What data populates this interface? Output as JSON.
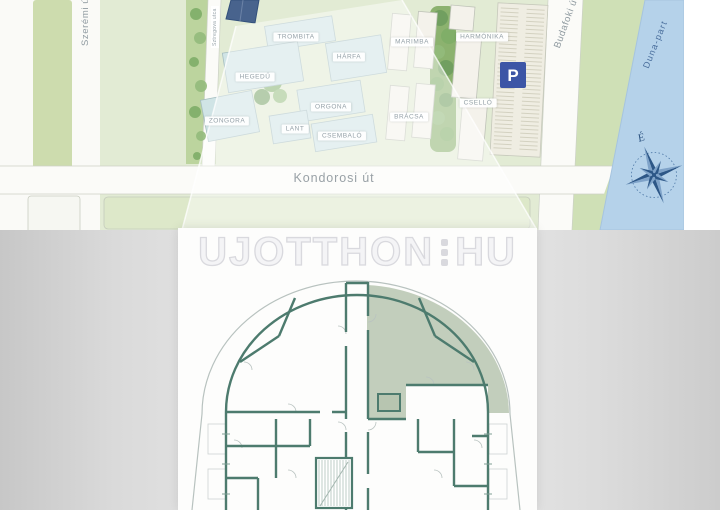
{
  "site_plan": {
    "streets": {
      "szeremi": "Szerémi út",
      "sztregova": "Sztregova utca",
      "kondorosi": "Kondorosi út",
      "budafoki": "Budafoki út",
      "duna_part": "Duna-part"
    },
    "compass_north": "É",
    "parking": "P",
    "buildings": [
      "ZONGORA",
      "HEGEDŰ",
      "TROMBITA",
      "HÁRFA",
      "ORGONA",
      "LANT",
      "CSEMBALÓ",
      "MARIMBA",
      "BRÁCSA",
      "HARMÓNIKA",
      "CSELLÓ"
    ],
    "colors": {
      "grass": "#e2ebd4",
      "median_green": "#cddcae",
      "tree_green": "#7fae68",
      "water_blue": "#b5d2ea",
      "compass_blue": "#2d5787",
      "teal_roof": "#d0e4e6",
      "selected_building_blue": "#48638d",
      "parking_blue": "#3c55a6",
      "label_gray": "#95a1a8"
    }
  },
  "watermark": {
    "name": "UJOTTHON",
    "tld": "HU"
  },
  "floor_plan": {
    "highlighted_unit": "top-right wing",
    "colors": {
      "wall_teal": "#4d7b6e",
      "highlight_sage": "#b7c5b0",
      "outline_gray": "#b8c2bf"
    }
  }
}
